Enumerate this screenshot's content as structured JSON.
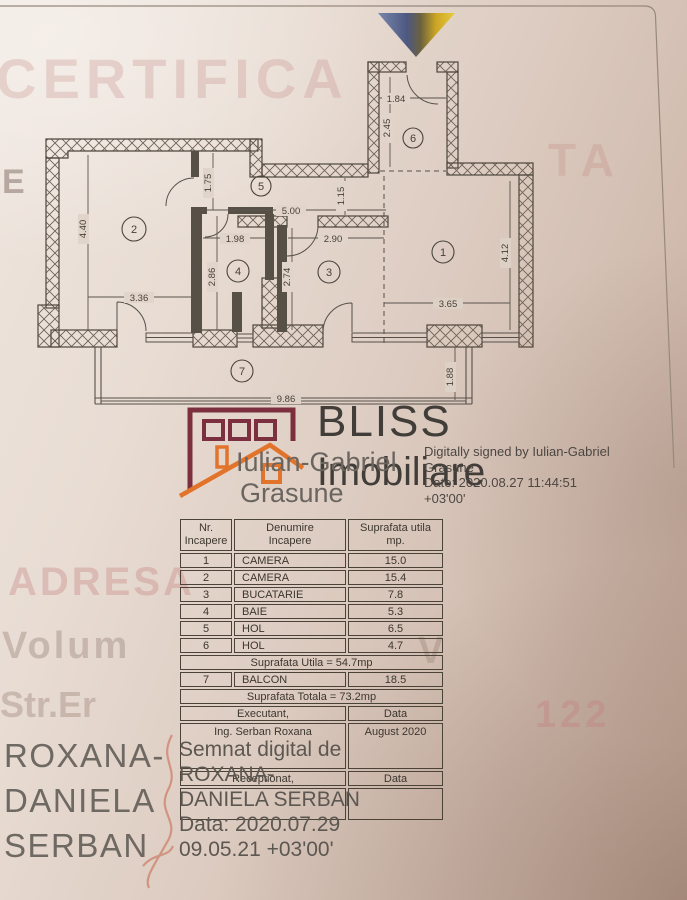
{
  "watermarks": {
    "top": "CERTIFICA",
    "top_right": "TA",
    "left_mark": "E",
    "adresa": "ADRESA",
    "volum": "Volum",
    "volum_v": "V",
    "street": "Str.Er",
    "street_no": "122"
  },
  "plan": {
    "room_labels": [
      "1",
      "2",
      "3",
      "4",
      "5",
      "6",
      "7"
    ],
    "dims": {
      "d1_84": "1.84",
      "d2_45": "2.45",
      "d1_75": "1.75",
      "d5_00": "5.00",
      "d1_15": "1.15",
      "d4_40": "4.40",
      "d3_36": "3.36",
      "d1_98": "1.98",
      "d2_86": "2.86",
      "d2_90": "2.90",
      "d2_74": "2.74",
      "d4_12": "4.12",
      "d3_65": "3.65",
      "d9_86": "9.86",
      "d1_88": "1.88"
    }
  },
  "logo": {
    "brand_top": "BLISS",
    "brand_bottom": "Imobiliare"
  },
  "surveyor_stamp": {
    "name_line1": "Iulian-Gabriel",
    "name_line2": "Grasune",
    "digital_line1": "Digitally signed by Iulian-Gabriel",
    "digital_line2": "Grasune",
    "digital_line3": "Date: 2020.08.27 11:44:51",
    "digital_line4": "+03'00'"
  },
  "table": {
    "header_col1": "Nr.\nIncapere",
    "header_col2": "Denumire\nIncapere",
    "header_col3": "Suprafata utila\nmp.",
    "rows": [
      {
        "nr": "1",
        "name": "CAMERA",
        "area": "15.0"
      },
      {
        "nr": "2",
        "name": "CAMERA",
        "area": "15.4"
      },
      {
        "nr": "3",
        "name": "BUCATARIE",
        "area": "7.8"
      },
      {
        "nr": "4",
        "name": "BAIE",
        "area": "5.3"
      },
      {
        "nr": "5",
        "name": "HOL",
        "area": "6.5"
      },
      {
        "nr": "6",
        "name": "HOL",
        "area": "4.7"
      }
    ],
    "subtotal": "Suprafata Utila = 54.7mp",
    "balcony": {
      "nr": "7",
      "name": "BALCON",
      "area": "18.5"
    },
    "total": "Suprafata Totala = 73.2mp",
    "executant_label": "Executant,",
    "executant_data_label": "Data",
    "executant_name": "Ing. Serban Roxana",
    "executant_date": "August 2020",
    "receptionat_label": "Receptionat,",
    "receptionat_data_label": "Data"
  },
  "engineer_stamp": {
    "big_line1": "ROXANA-",
    "big_line2": "DANIELA",
    "big_line3": "SERBAN",
    "digital_line1": "Semnat digital de",
    "digital_line2": "ROXANA-",
    "digital_line3": "DANIELA SERBAN",
    "digital_line4": "Data: 2020.07.29",
    "digital_line5": "09.05.21 +03'00'"
  }
}
